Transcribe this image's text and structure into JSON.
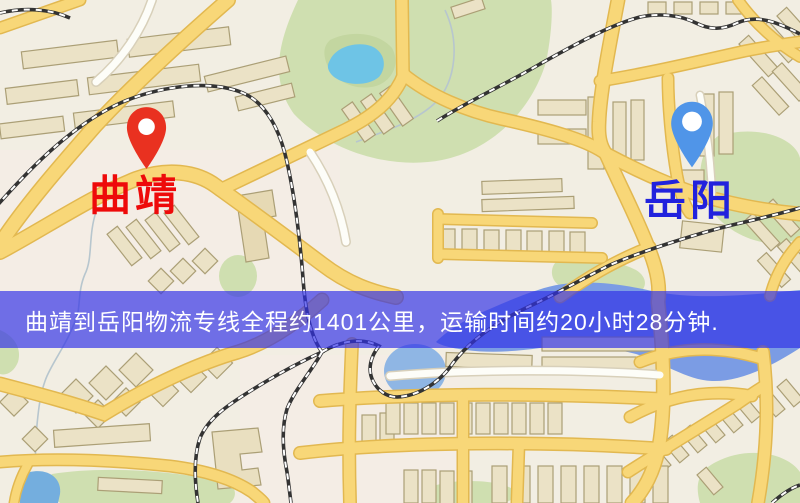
{
  "title": "曲靖到岳阳物流专线地图",
  "map": {
    "origin": {
      "name": "曲靖",
      "pin_icon": "red-location-pin",
      "pin_color": "#e93120",
      "label_color": "#ee0a0a"
    },
    "destination": {
      "name": "岳阳",
      "pin_icon": "blue-location-pin",
      "pin_color": "#5095e8",
      "label_color": "#2122dd"
    },
    "banner": {
      "text": "曲靖到岳阳物流专线全程约1401公里，运输时间约20小时28分钟.",
      "distance_km": "1401公里",
      "duration": "20小时28分钟",
      "background": "#3030e8",
      "text_color": "#ffffff"
    },
    "colors": {
      "land": "#f2eee3",
      "road": "#f8d778",
      "road_casing": "#e2b850",
      "minor_road": "#fdfdf8",
      "minor_road_casing": "#d8d0ba",
      "building": "#ebe2c6",
      "building_stroke": "#ab9f76",
      "green_area": "#cfdfb0",
      "green_dark": "#c3d6a0",
      "water": "#7b9ce4",
      "pond": "#6ec4e6",
      "pond_mid": "#8fb6e4",
      "lake": "#74aede",
      "railway": "#333333",
      "stream": "#b7c6ce"
    }
  }
}
